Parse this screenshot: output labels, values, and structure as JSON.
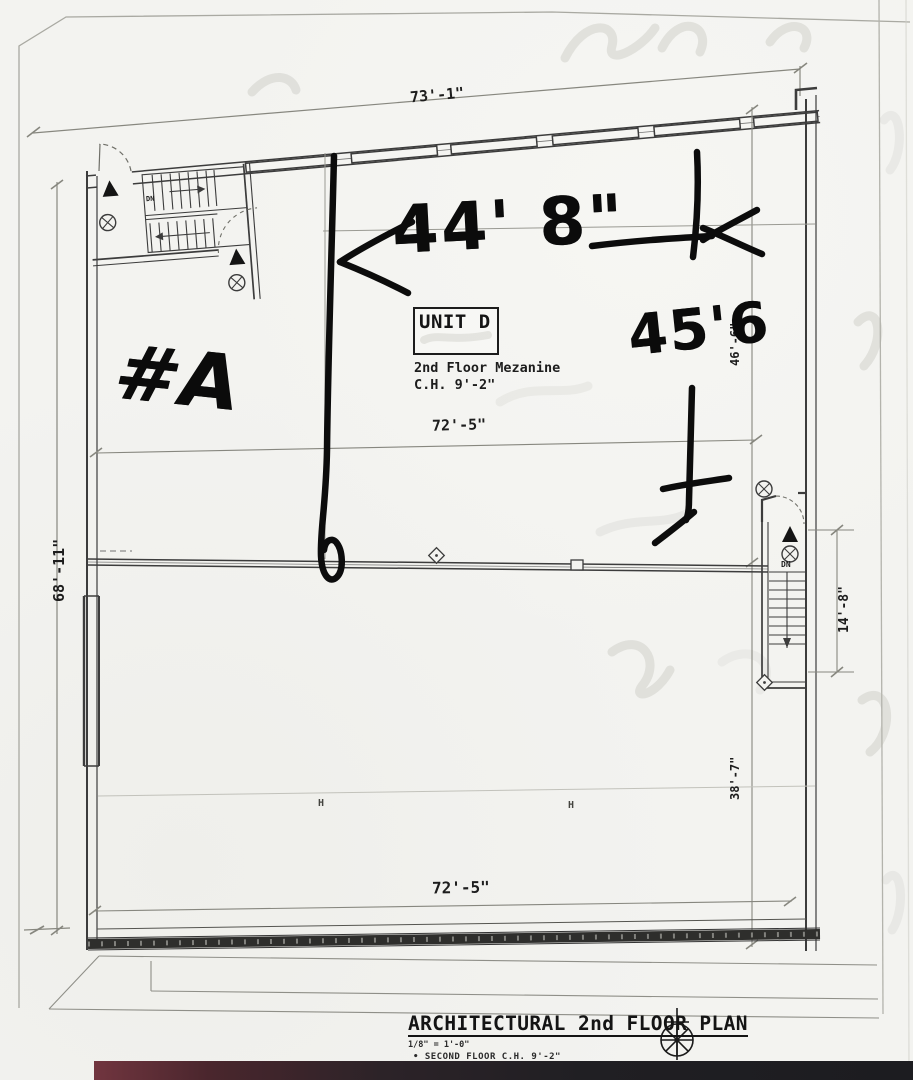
{
  "title_block": {
    "title": "ARCHITECTURAL 2nd FLOOR PLAN",
    "scale": "1/8\" = 1'-0\"",
    "bullet_note": "•   SECOND FLOOR C.H. 9'-2\""
  },
  "unit_box": {
    "label": "UNIT D",
    "line1": "2nd Floor Mezanine",
    "line2": "C.H.  9'-2\""
  },
  "dims": {
    "top": "73'-1\"",
    "mid": "72'-5\"",
    "bottom": "72'-5\"",
    "left": "68'-11\"",
    "right_upper": "46'-6\"",
    "right_lower": "38'-7\"",
    "stair": "14'-8\""
  },
  "stairs": {
    "left_dn": "DN",
    "right_dn": "DN"
  },
  "handwritten": {
    "width": "44' 8\"",
    "height": "45'6",
    "unit": "#A"
  },
  "columns": {
    "c1": "H",
    "c2": "H"
  }
}
